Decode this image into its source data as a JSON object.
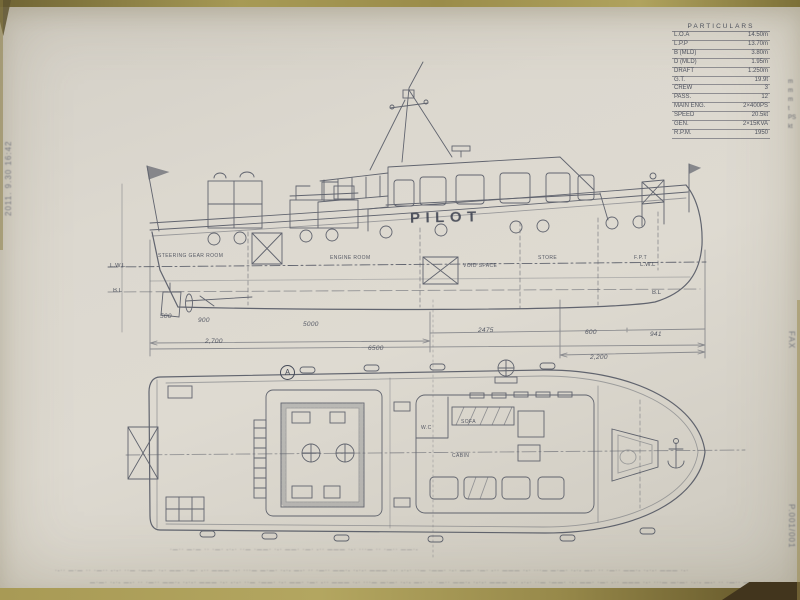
{
  "fax_margins": {
    "left_header": "2011. 9.30  16:42",
    "right_fax": "FAX",
    "right_page": "P.001/001",
    "bottom_smear_1": "·-·· —·— ·· ·—·· -·-· ··— ·——· ·-· ——· ·—· -·· ——— ·-· ···— —·—· ·-·- —-· ·· ·—·· ——·- ·-·-· ——— ·-· -·-· ··— ·——· ·-· ——· ·—· -·· ——— ·-· ···— —·—· ·-·- —-· ·· ·—·· ——·- ·-·-· ——— ·-·",
    "bottom_smear_2": "—·—· ·-·- —-· ·· ·—·· ——·- ·-·-· ——— ·-· -·-· ··— ·——· ·-· ——· ·—· -·· ——— ·-· ···— —·—· ·-·- —-· ·· ·—·· ——·- ·-·-· ——— ·-· -·-· ··— ·——· ·-· ——· ·—· -·· ——— ·-· ···— —·—· ·-·- —-· ·· ·—·· ——·- ·-·",
    "plan_caption": "·—·· —·— ·· ·—· -·-· ··— ·——· ·-· ——· ·—· -·· ——— ·-· ···— ·· ·—·· ——·-"
  },
  "spec_table": {
    "title": "PARTICULARS",
    "units_fragment": "m\nm\nm\nt\nPS\nkt",
    "rows": [
      {
        "label": "L.O.A",
        "value": "14.50m"
      },
      {
        "label": "L.P.P",
        "value": "13.70m"
      },
      {
        "label": "B (MLD)",
        "value": "3.80m"
      },
      {
        "label": "D (MLD)",
        "value": "1.95m"
      },
      {
        "label": "DRAFT",
        "value": "1.250m"
      },
      {
        "label": "G.T.",
        "value": "19.9t"
      },
      {
        "label": "CREW",
        "value": "3"
      },
      {
        "label": "PASS.",
        "value": "12"
      },
      {
        "label": "MAIN ENG.",
        "value": "2×400PS"
      },
      {
        "label": "SPEED",
        "value": "20.5kt"
      },
      {
        "label": "GEN.",
        "value": "2×15KVA"
      },
      {
        "label": "R.P.M.",
        "value": "1950"
      }
    ]
  },
  "side_view": {
    "name_on_hull": "PILOT",
    "compartments": {
      "steering": "STEERING GEAR ROOM",
      "engine": "ENGINE ROOM",
      "void": "VOID SPACE",
      "store": "STORE",
      "fpt": "F.P.T"
    },
    "waterlines": {
      "lwl_aft": "L.W.L",
      "bl_aft": "B.L",
      "lwl_fwd": "L.W.L",
      "bl_fwd": "B.L"
    },
    "dims": {
      "d500": "500",
      "d900": "900",
      "d5000": "5000",
      "d2475": "2475",
      "d600": "600",
      "d941": "941",
      "d2700": "2,700",
      "d6500": "6500",
      "d2200": "2,200"
    }
  },
  "plan_view": {
    "sofa": "SOFA",
    "cabin": "CABIN",
    "wc": "W.C",
    "section_marker": "A"
  }
}
